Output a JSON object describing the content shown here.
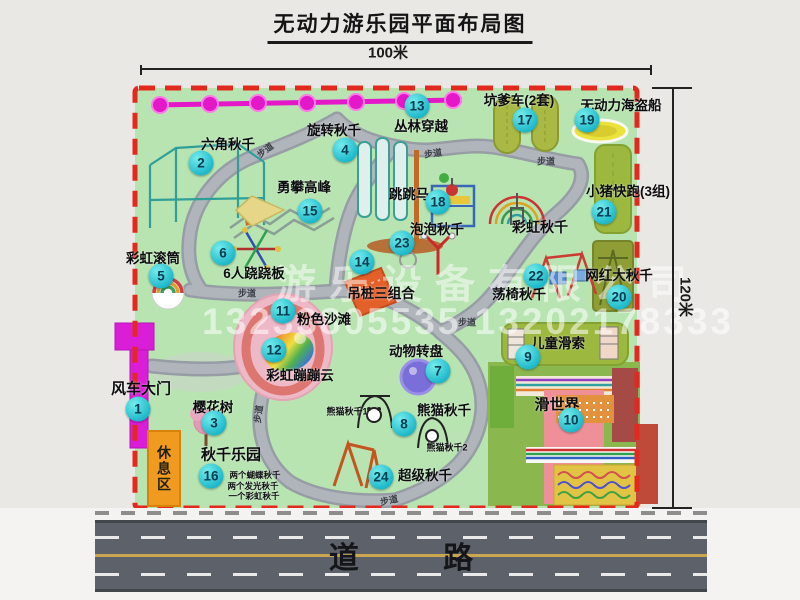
{
  "title": "无动力游乐园平面布局图",
  "dimensions": {
    "width": "100米",
    "height": "120米"
  },
  "road_label": "道 路",
  "rest_area_label": "休息区",
  "path_label_text": "步道",
  "watermark": {
    "company": "游乐设备有限公司",
    "phone": "13233805535 13202178333"
  },
  "colors": {
    "map_green": "#b7e4b0",
    "border_red": "#e3291d",
    "badge_cyan": "#19b6c9",
    "gate_magenta": "#da1ed8",
    "zipline_magenta": "#e417c9",
    "rest_orange": "#f09a20",
    "road_gray": "#5d6169",
    "path_gray": "#aeb3b9"
  },
  "map": {
    "attractions": [
      {
        "n": 1,
        "name": "风车大门",
        "lx": 141,
        "ly": 388,
        "bx": 138,
        "by": 409,
        "ls": 15
      },
      {
        "n": 2,
        "name": "六角秋千",
        "lx": 228,
        "ly": 143,
        "bx": 201,
        "by": 163
      },
      {
        "n": 3,
        "name": "樱花树",
        "lx": 213,
        "ly": 406,
        "bx": 214,
        "by": 423
      },
      {
        "n": 4,
        "name": "旋转秋千",
        "lx": 334,
        "ly": 129,
        "bx": 345,
        "by": 150
      },
      {
        "n": 5,
        "name": "彩虹滚筒",
        "lx": 153,
        "ly": 257,
        "bx": 161,
        "by": 276
      },
      {
        "n": 6,
        "name": "6人跷跷板",
        "lx": 254,
        "ly": 272,
        "bx": 223,
        "by": 253
      },
      {
        "n": 7,
        "name": "动物转盘",
        "lx": 416,
        "ly": 350,
        "bx": 438,
        "by": 371
      },
      {
        "n": 8,
        "name": "熊猫秋千",
        "lx": 444,
        "ly": 409,
        "bx": 404,
        "by": 424
      },
      {
        "n": 9,
        "name": "儿童滑索",
        "lx": 558,
        "ly": 342,
        "bx": 528,
        "by": 357
      },
      {
        "n": 10,
        "name": "滑世界",
        "lx": 557,
        "ly": 404,
        "bx": 571,
        "by": 420,
        "ls": 15
      },
      {
        "n": 11,
        "name": "粉色沙滩",
        "lx": 324,
        "ly": 318,
        "bx": 283,
        "by": 311
      },
      {
        "n": 12,
        "name": "彩虹蹦蹦云",
        "lx": 300,
        "ly": 374,
        "bx": 274,
        "by": 350
      },
      {
        "n": 13,
        "name": "丛林穿越",
        "lx": 421,
        "ly": 125,
        "bx": 417,
        "by": 106
      },
      {
        "n": 14,
        "name": "吊桩三组合",
        "lx": 381,
        "ly": 292,
        "bx": 362,
        "by": 262
      },
      {
        "n": 15,
        "name": "勇攀高峰",
        "lx": 304,
        "ly": 186,
        "bx": 310,
        "by": 211
      },
      {
        "n": 16,
        "name": "秋千乐园",
        "lx": 231,
        "ly": 454,
        "bx": 211,
        "by": 476,
        "ls": 15
      },
      {
        "n": 17,
        "name": "坑爹车(2套)",
        "lx": 519,
        "ly": 99,
        "bx": 525,
        "by": 120
      },
      {
        "n": 18,
        "name": "跳跳马",
        "lx": 409,
        "ly": 193,
        "bx": 438,
        "by": 202
      },
      {
        "n": 19,
        "name": "无动力海盗船",
        "lx": 621,
        "ly": 104,
        "bx": 587,
        "by": 120
      },
      {
        "n": 20,
        "name": "网红大秋千",
        "lx": 619,
        "ly": 274,
        "bx": 619,
        "by": 297
      },
      {
        "n": 21,
        "name": "小猪快跑(3组)",
        "lx": 628,
        "ly": 190,
        "bx": 604,
        "by": 212
      },
      {
        "n": 22,
        "name": "荡椅秋千",
        "lx": 519,
        "ly": 293,
        "bx": 536,
        "by": 276
      },
      {
        "n": 23,
        "name": "泡泡秋千",
        "lx": 437,
        "ly": 228,
        "bx": 402,
        "by": 243
      },
      {
        "n": 24,
        "name": "超级秋千",
        "lx": 425,
        "ly": 474,
        "bx": 381,
        "by": 477
      }
    ],
    "extra_labels": [
      {
        "text": "彩虹秋千",
        "x": 540,
        "y": 227,
        "s": 14
      },
      {
        "text": "熊猫秋千1",
        "x": 347,
        "y": 411,
        "s": 9
      },
      {
        "text": "熊猫秋千2",
        "x": 447,
        "y": 447,
        "s": 9
      },
      {
        "text": "两个蝴蝶秋千",
        "x": 255,
        "y": 475,
        "s": 8.5
      },
      {
        "text": "两个发光秋千",
        "x": 253,
        "y": 486,
        "s": 8.5
      },
      {
        "text": "一个彩虹秋千",
        "x": 254,
        "y": 496,
        "s": 8.5
      }
    ],
    "path_labels": [
      {
        "x": 265,
        "y": 150,
        "rot": -38
      },
      {
        "x": 433,
        "y": 153,
        "rot": -8
      },
      {
        "x": 546,
        "y": 161,
        "rot": 0
      },
      {
        "x": 247,
        "y": 293,
        "rot": 0
      },
      {
        "x": 467,
        "y": 322,
        "rot": 0
      },
      {
        "x": 258,
        "y": 414,
        "rot": -82
      },
      {
        "x": 389,
        "y": 500,
        "rot": -12
      }
    ],
    "icons": {
      "windmill-gate-icon": "magenta-bar",
      "jungle-zipline-icon": "magenta-dotted-line",
      "hexagon-swing-icon": "teal-frame",
      "rotating-swing-icon": "teal-panels",
      "climbing-peak-icon": "rope-bridge",
      "rainbow-roller-icon": "striped-drum",
      "seesaw-icon": "crossed-beams",
      "jumping-horse-icon": "blue-frame",
      "pit-car-icon": "two-green-tracks",
      "pirate-ship-icon": "yellow-ellipse",
      "piggy-run-icon": "green-track",
      "rainbow-swing-icon": "rainbow-arches",
      "bubble-swing-icon": "red-pole",
      "hanging-pile-icon": "orange-mat",
      "pink-beach-icon": "pink-blob-rainbow-cloud",
      "animal-turntable-icon": "purple-disc",
      "swing-chair-icon": "red-a-frames",
      "internet-swing-icon": "green-panel-frame",
      "kids-zipline-icon": "green-strip-towers",
      "slide-world-icon": "striped-slides",
      "panda-swing-icon": "black-arches",
      "super-swing-icon": "orange-a-frame",
      "cherry-tree-icon": "pink-tree"
    }
  }
}
